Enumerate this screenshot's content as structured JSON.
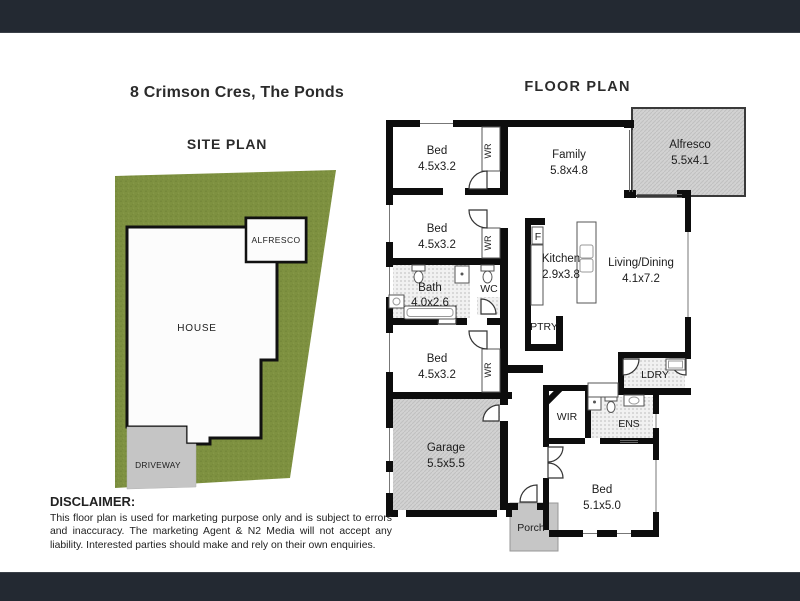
{
  "header": {
    "address": "8 Crimson Cres, The Ponds"
  },
  "site_plan": {
    "title": "SITE PLAN",
    "house_label": "HOUSE",
    "alfresco_label": "ALFRESCO",
    "driveway_label": "DRIVEWAY"
  },
  "floor_plan": {
    "title": "FLOOR PLAN",
    "rooms": [
      {
        "name": "Bed",
        "dims": "4.5x3.2"
      },
      {
        "name": "Bed",
        "dims": "4.5x3.2"
      },
      {
        "name": "Bath",
        "dims": "4.0x2.6"
      },
      {
        "name": "Bed",
        "dims": "4.5x3.2"
      },
      {
        "name": "Family",
        "dims": "5.8x4.8"
      },
      {
        "name": "Kitchen",
        "dims": "2.9x3.8"
      },
      {
        "name": "Living/Dining",
        "dims": "4.1x7.2"
      },
      {
        "name": "Alfresco",
        "dims": "5.5x4.1"
      },
      {
        "name": "Garage",
        "dims": "5.5x5.5"
      },
      {
        "name": "Bed",
        "dims": "5.1x5.0"
      }
    ],
    "labels": {
      "wr": "WR",
      "wc": "WC",
      "fridge": "F",
      "pantry": "PTRY",
      "laundry": "LDRY",
      "linen": "LIN",
      "wir": "WIR",
      "ensuite": "ENS",
      "porch": "Porch"
    }
  },
  "disclaimer": {
    "heading": "DISCLAIMER:",
    "body": "This floor plan is used for marketing purpose only and is subject to errors and inaccuracy. The marketing Agent & N2 Media will not accept any liability. Interested parties should make and rely on their own enquiries."
  },
  "colors": {
    "top_bottom_bar": "#232932",
    "lot_green": "#7E9140",
    "area_gray": "#D2D2D2",
    "wall_black": "#0D0D0D"
  }
}
